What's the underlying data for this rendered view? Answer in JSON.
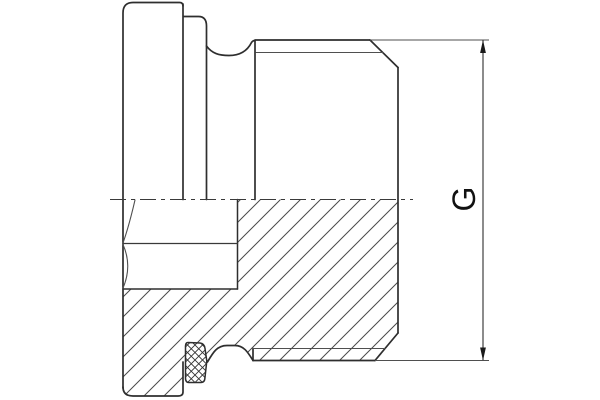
{
  "drawing": {
    "dimension_label": "G"
  },
  "colors": {
    "background": "#ffffff",
    "outline": "#2e2e2e",
    "thin_line": "#4f4f4f",
    "hatch": "#4a4a4a",
    "seal_hatch": "#333333",
    "text": "#111111"
  }
}
